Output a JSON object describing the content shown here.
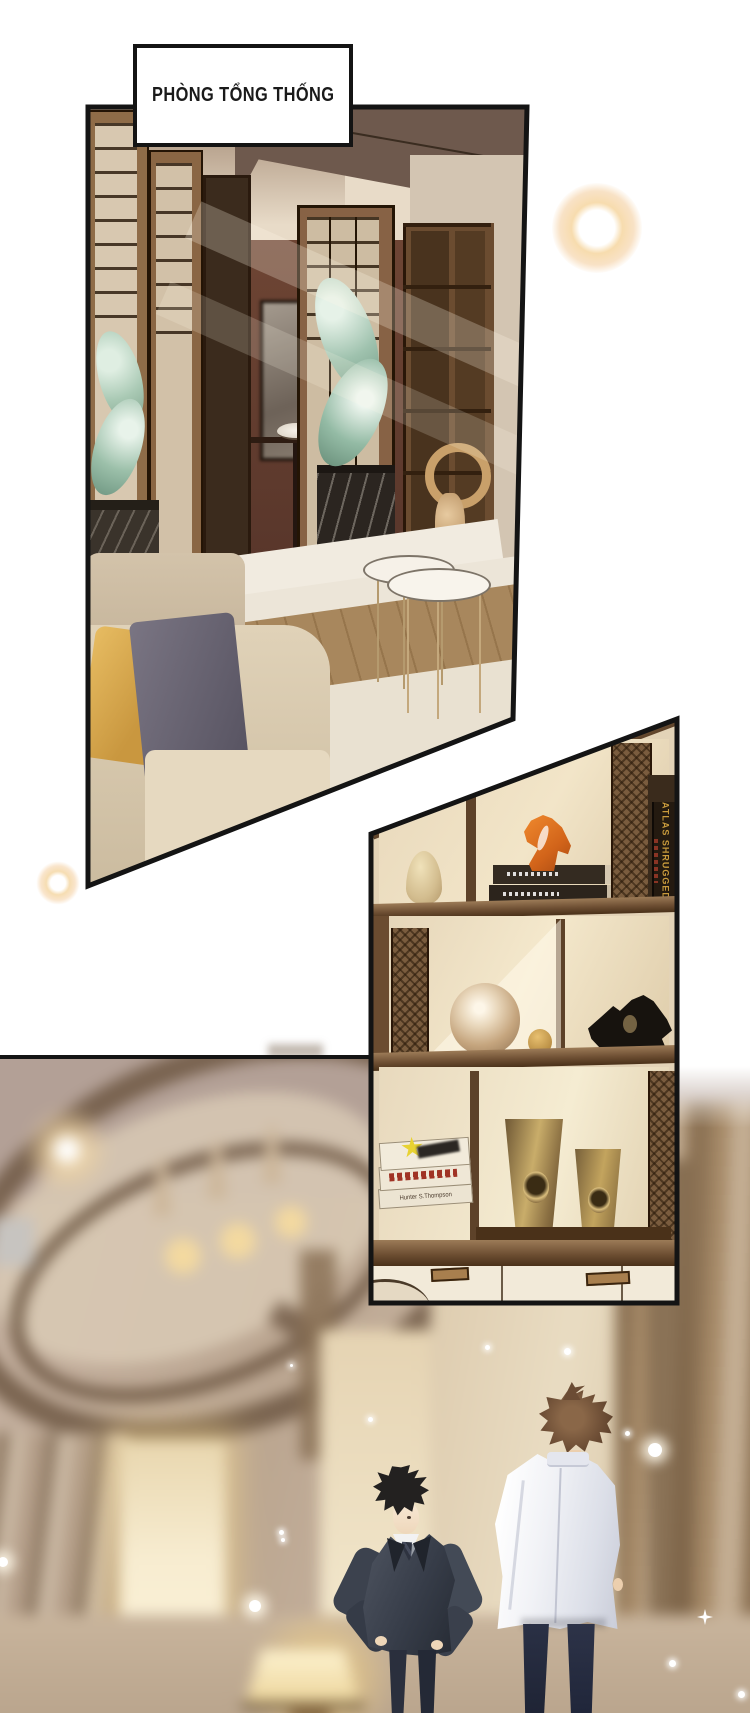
{
  "comic": {
    "caption": "PHÒNG TỔNG THỐNG",
    "books": {
      "atlas_spine": "ATLAS SHRUGGED",
      "author_spine": "Hunter S.Thompson"
    },
    "palette": {
      "paper": "#ffffff",
      "ink": "#141414",
      "glow_warm": "#f2c58d",
      "glass_green": "#9fc2ae",
      "sculpture_orange": "#e0761f",
      "brass_gold": "#c0a45e",
      "pillow_gold": "#d9a84e",
      "suit_charcoal": "#3a3f49",
      "jacket_white": "#f4f4f8",
      "wood_brown": "#7a5a3a"
    }
  }
}
